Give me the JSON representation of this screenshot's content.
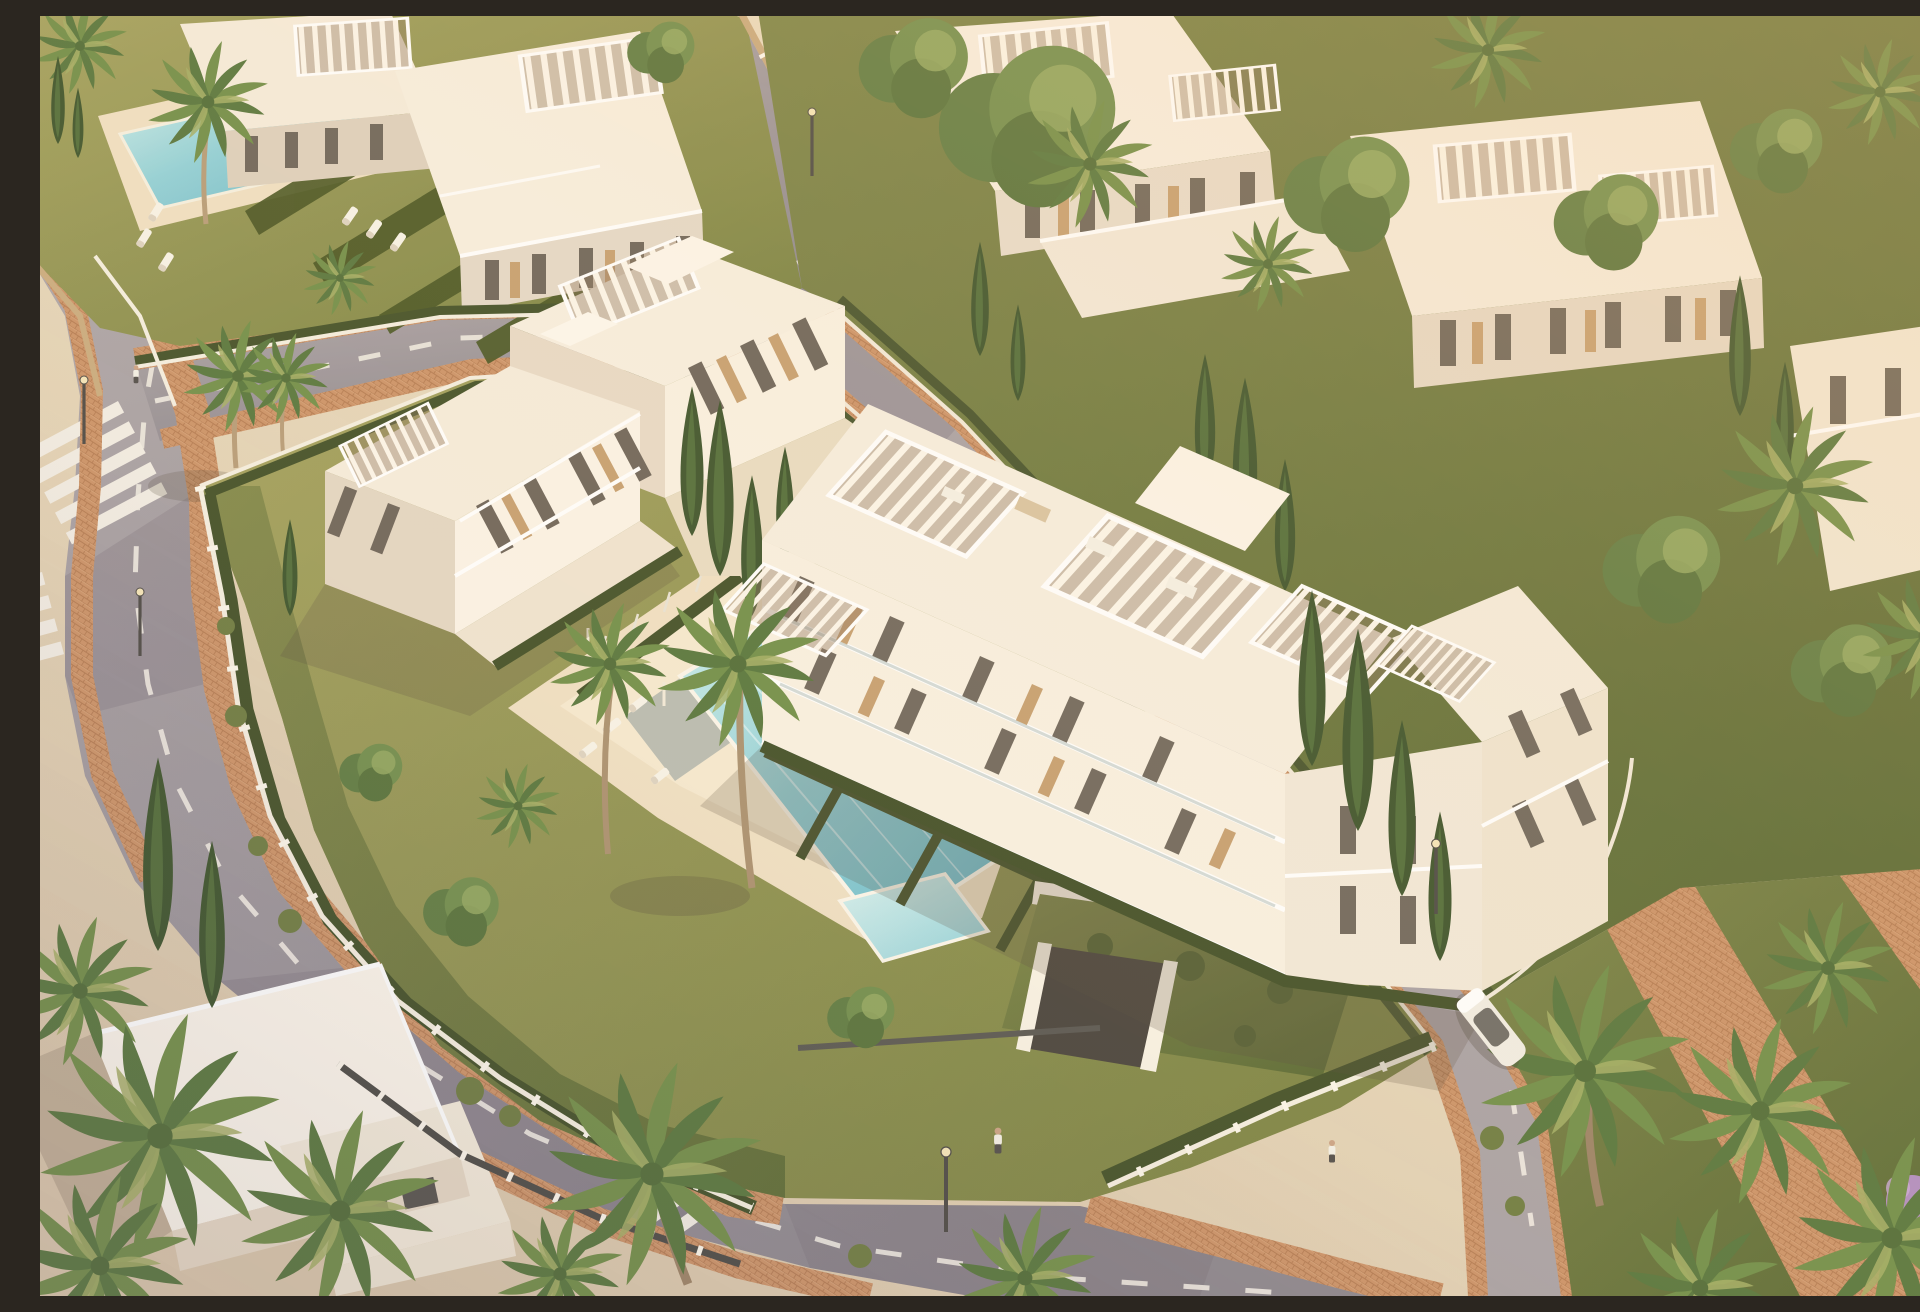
{
  "scene": {
    "title": "Aerial render of a modern white residential complex at golden hour",
    "description": "Photorealistic aerial 3D architectural rendering: a gated complex of modern white apartment buildings with slatted roof pergolas and terraces, a turquoise communal lap pool with a children's pool, olive-green lawns with sun loungers, dark clipped hedges, palm and cypress trees, curved asphalt streets with zebra crosswalks, terracotta brick sidewalks and promenades, a gated herringbone-paved entrance driveway with underground garage, a parked white car and a few pedestrians, all bathed in warm late-afternoon light coming from the upper right.",
    "time_of_day": "golden hour",
    "sun_direction": "upper right",
    "palette": {
      "sunlit_white": "#fbf4e6",
      "warm_white": "#f6ecdb",
      "shaded_white": "#e2d4c1",
      "deep_shade": "#cdbfae",
      "sand_ground": "#e6d6ba",
      "deck_stone": "#efdfc2",
      "asphalt": "#a29aa0",
      "asphalt_dark": "#7e7880",
      "road_marking": "#efeae2",
      "brick_path": "#cb9166",
      "herringbone": "#d9a273",
      "pool_shallow": "#c9ebea",
      "pool_deep": "#66b6c6",
      "kids_pool": "#a5dade",
      "lawn_light": "#a3a05c",
      "lawn": "#87894a",
      "lawn_dark": "#5f6b36",
      "hedge": "#3f4d24",
      "palm_light": "#a3ad62",
      "palm": "#6f8c45",
      "palm_dark": "#55743a",
      "cypress": "#3a5129",
      "wood_accent": "#c69e6e",
      "fence_wood": "#c9a97c",
      "lamp_post": "#4a4742",
      "flower_bush": "#b08bc0"
    },
    "features": {
      "main_buildings": [
        "west apartment block with roof pergolas",
        "east apartment block with tiered terraces and east wing"
      ],
      "neighbour_buildings": [
        "top-left complex with private lap pool",
        "top-right stepped apartment block",
        "far-right apartment block",
        "bottom-left villa"
      ],
      "pools": [
        "communal lap pool",
        "children's pool",
        "neighbouring lap pool"
      ],
      "roads": [
        "curved main street (left to bottom)",
        "north side street",
        "upper service road",
        "rear lane along east side"
      ],
      "crosswalk_count": 4,
      "entrance": "gated driveway with herringbone terracotta paving and underground garage with green roof",
      "vegetation": [
        "palm trees",
        "cypress trees",
        "clipped hedges",
        "leafy trees",
        "lawns",
        "flowering bush"
      ],
      "props": [
        "sun loungers",
        "street lamps",
        "parked white car",
        "pedestrians",
        "rooftop lounge furniture"
      ]
    }
  }
}
